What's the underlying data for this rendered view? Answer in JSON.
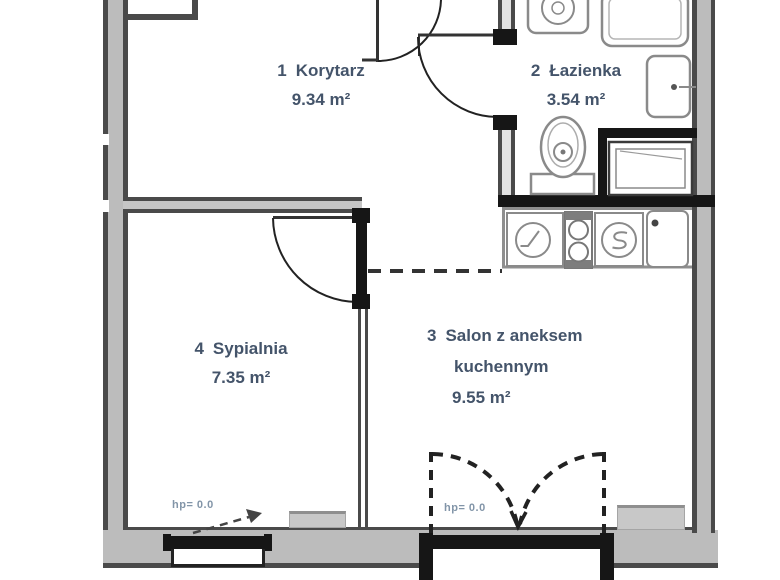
{
  "plan_title": "apartment-floor-plan",
  "rooms": [
    {
      "number": "1",
      "name": "Korytarz",
      "area": "9.34 m²"
    },
    {
      "number": "2",
      "name": "Łazienka",
      "area": "3.54 m²"
    },
    {
      "number": "3",
      "name": "Salon z aneksem",
      "name_line2": "kuchennym",
      "area": "9.55 m²"
    },
    {
      "number": "4",
      "name": "Sypialnia",
      "area": "7.35 m²"
    }
  ],
  "window_labels": {
    "bedroom_window_hp": "hp= 0.0",
    "balcony_door_hp": "hp= 0.0"
  },
  "fixtures": {
    "washing_machine": "washing-machine-icon",
    "shower": "shower-tray-icon",
    "washbasin": "washbasin-icon",
    "toilet": "toilet-icon",
    "bathtub": "bathtub-icon",
    "kitchen_sink": "kitchen-sink-icon",
    "stove": "two-burner-stove-icon",
    "kitchen_appliance": "kitchen-appliance-icon",
    "fridge_basin": "counter-basin-icon",
    "radiator_bedroom": "radiator",
    "radiator_living": "radiator"
  },
  "colors": {
    "wall_fill": "#bcbcbc",
    "wall_edge": "#4a4a4a",
    "black_elements": "#161616",
    "room_label": "#44546a",
    "hp_label": "#8295a8",
    "fixture_stroke": "#8a8a8a"
  }
}
